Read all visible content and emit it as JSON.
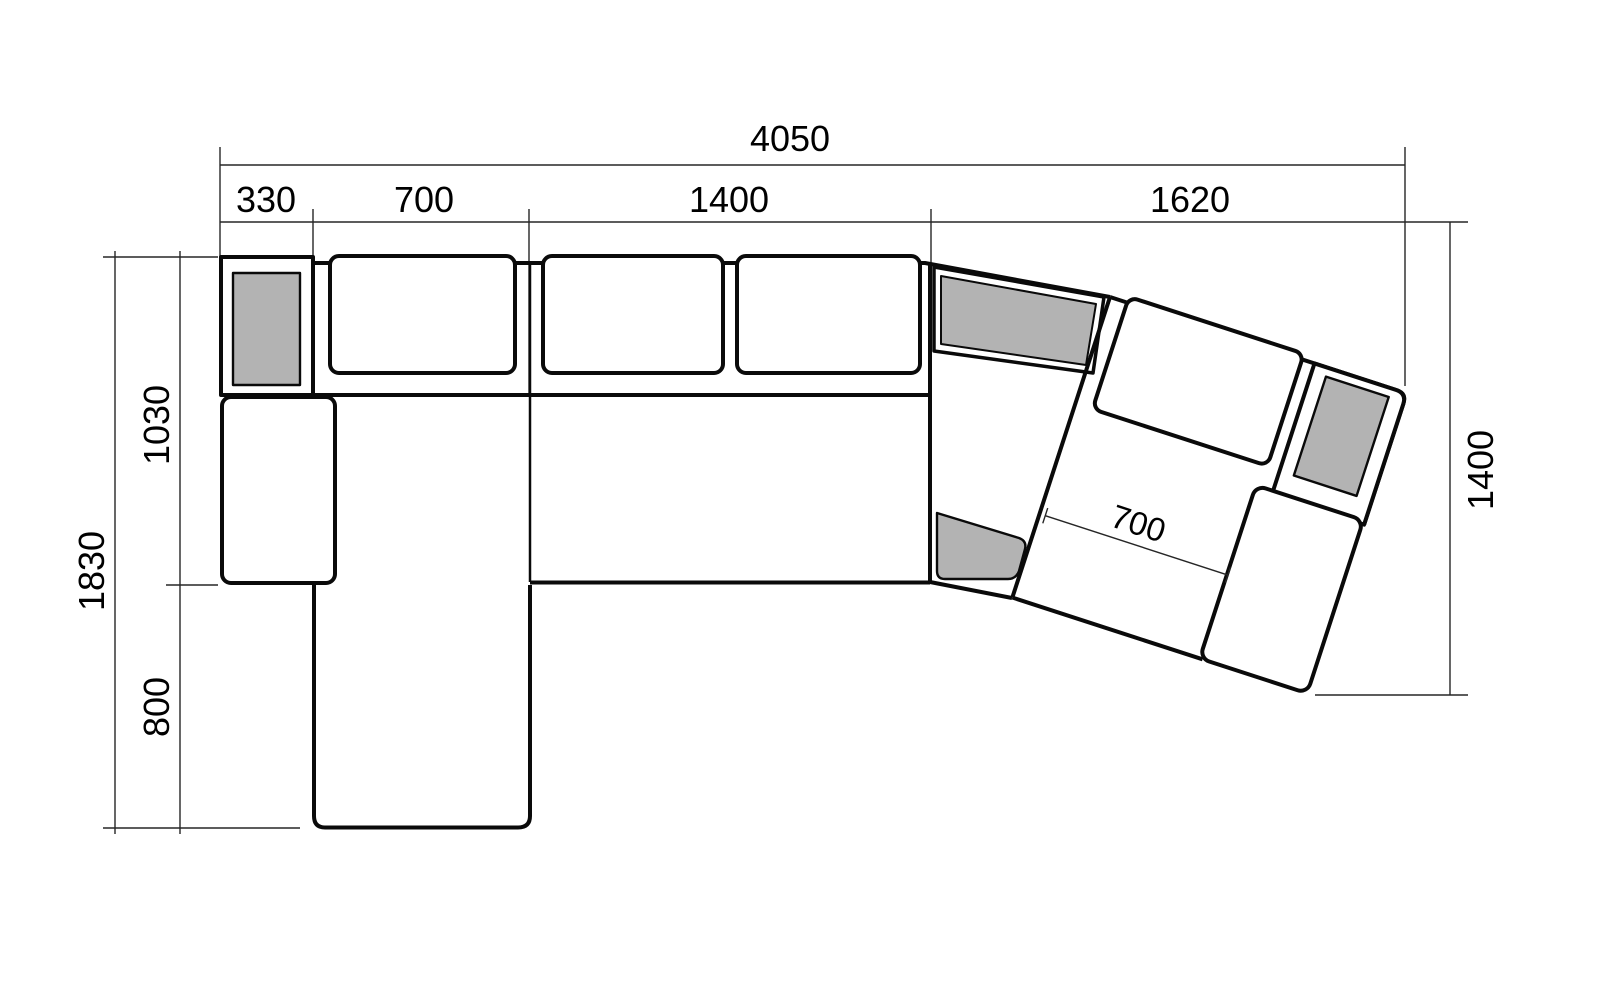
{
  "drawing": {
    "type": "furniture-plan-diagram",
    "subject": "corner sectional sofa top view with dimensions",
    "units_implied": "mm"
  },
  "colors": {
    "background": "#ffffff",
    "outline": "#0a0a0a",
    "cushion_gray": "#b3b3b3",
    "dim_line": "#262626",
    "text": "#000000"
  },
  "dimensions": {
    "overall_width": {
      "label": "4050"
    },
    "segments": [
      {
        "label": "330"
      },
      {
        "label": "700"
      },
      {
        "label": "1400"
      },
      {
        "label": "1620"
      }
    ],
    "depth_total": {
      "label": "1830"
    },
    "depth_upper": {
      "label": "1030"
    },
    "depth_lower": {
      "label": "800"
    },
    "right_extent": {
      "label": "1400"
    },
    "angled_seat_width": {
      "label": "700"
    }
  }
}
